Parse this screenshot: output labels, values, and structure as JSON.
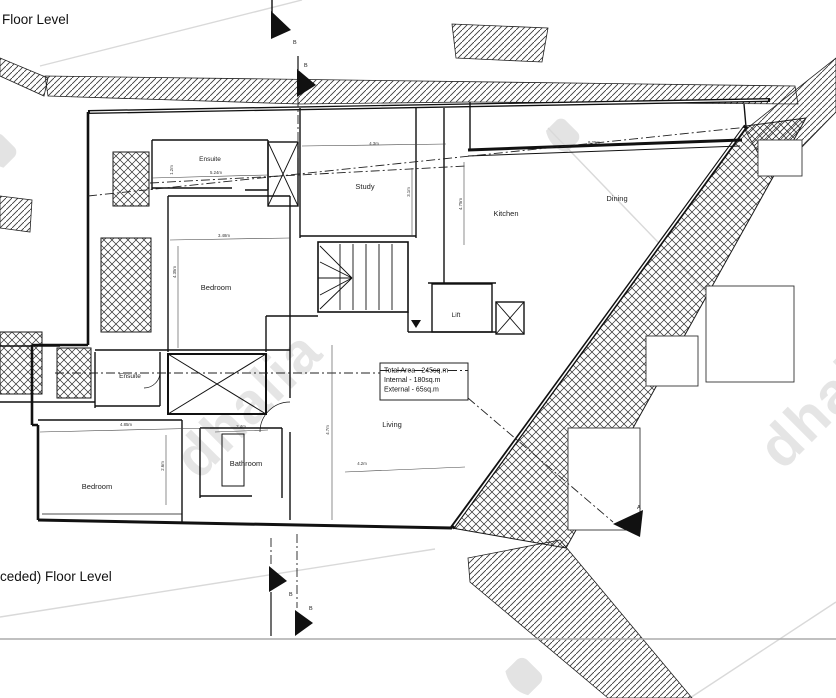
{
  "titles": {
    "top": "Floor Level",
    "bottom": "ceded) Floor Level"
  },
  "rooms": {
    "ensuite_upper": "Ensuite",
    "study": "Study",
    "kitchen": "Kitchen",
    "dining": "Dining",
    "bedroom_upper": "Bedroom",
    "lift": "Lift",
    "ensuite_lower": "Ensuite",
    "living": "Living",
    "bathroom": "Bathroom",
    "bedroom_lower": "Bedroom"
  },
  "area_box": {
    "total": "Total Area - 245sq.m",
    "internal": "Internal - 180sq.m",
    "external": "External - 65sq.m"
  },
  "dimensions": {
    "study_width": "4.3m",
    "dining_width": "9.25m",
    "ensuite_width": "5.24m",
    "ensuite_depth": "1.2m",
    "bedroom_width": "3.48m",
    "bedroom_depth": "4.35m",
    "study_depth": "3.1m",
    "kitchen_depth": "4.75m",
    "bedroom_lower_width": "4.85m",
    "bedroom_lower_depth": "2.6m",
    "bathroom_width": "2.4m",
    "living_depth": "4.7m",
    "living_width": "4.2m"
  },
  "section_markers": {
    "a": "A",
    "b": "B"
  },
  "watermark": {
    "text": "dhalia"
  },
  "colors": {
    "ink": "#1a1a1a",
    "watermark": "#e5e5e5",
    "separator": "#ababab"
  }
}
